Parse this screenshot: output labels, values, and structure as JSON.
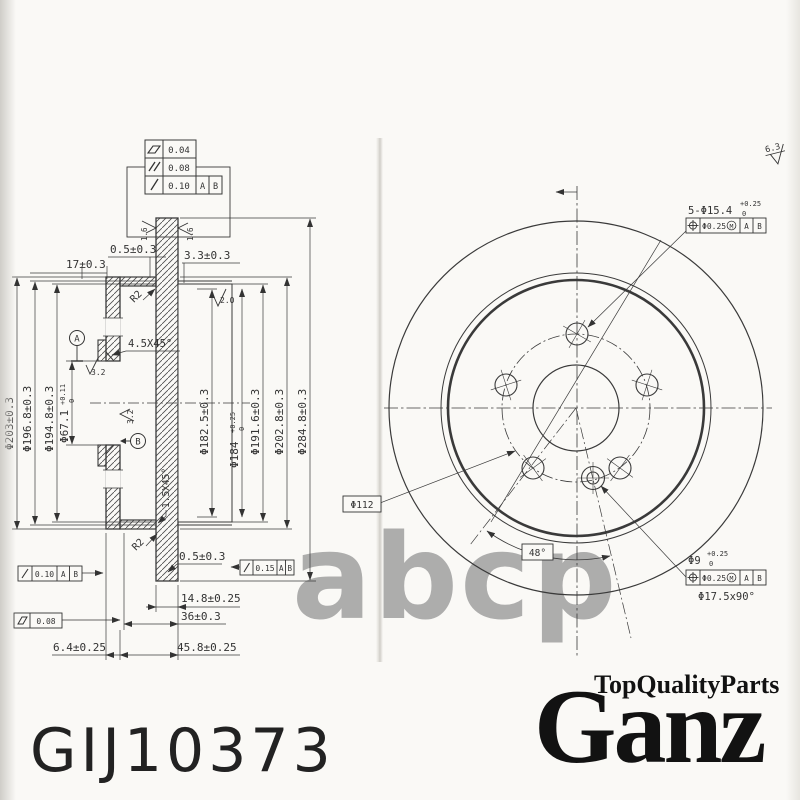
{
  "paper": {
    "bg": "#faf9f6",
    "line_color": "#3a3a3a",
    "watermark_color": "#a0a0a0"
  },
  "watermark": {
    "text": "abcp"
  },
  "part_number": "GIJ10373",
  "brand": {
    "tagline": "TopQualityParts",
    "name": "Ganz"
  },
  "tolerance_table": {
    "rows": [
      {
        "symbol_name": "flatness-symbol",
        "value": "0.04"
      },
      {
        "symbol_name": "parallelism-symbol",
        "value": "0.08"
      },
      {
        "symbol_name": "runout-symbol",
        "value": "0.10",
        "datum_1": "A",
        "datum_2": "B"
      }
    ]
  },
  "section_view": {
    "dims_top": {
      "d17": "17±0.3",
      "d05": "0.5±0.3",
      "d33": "3.3±0.3"
    },
    "roughness": {
      "r16_left": "1.6",
      "r16_right": "1.6",
      "r20": "2.0",
      "r32_hub": "3.2",
      "r32_face": "3.2"
    },
    "radii": {
      "r2_top": "R2",
      "r2_bottom": "R2"
    },
    "chamfers": {
      "c45": "4.5X45°",
      "c15": "1.5X45°"
    },
    "diameters_left": {
      "d203": "Φ203±0.3",
      "d196": "Φ196.8±0.3",
      "d194": "Φ194.8±0.3",
      "d67_main": "Φ67.1",
      "d67_tol_up": "+0.11",
      "d67_tol_dn": "0"
    },
    "diameters_right": {
      "d182": "Φ182.5±0.3",
      "d184_main": "Φ184",
      "d184_tol_up": "+0.25",
      "d184_tol_dn": "0",
      "d191": "Φ191.6±0.3",
      "d202": "Φ202.8±0.3",
      "d284": "Φ284.8±0.3"
    },
    "datums": {
      "a": "A",
      "b": "B"
    },
    "dims_bottom": {
      "d05": "0.5±0.3",
      "d148": "14.8±0.25",
      "d36": "36±0.3",
      "d64": "6.4±0.25",
      "d458": "45.8±0.25"
    },
    "fcf": {
      "runout_face": {
        "value": "0.15",
        "datum_1": "A",
        "datum_2": "B"
      },
      "runout_hub": {
        "value": "0.10",
        "datum_1": "A",
        "datum_2": "B"
      },
      "flatness": {
        "value": "0.08"
      }
    }
  },
  "front_view": {
    "roughness": "6.3",
    "bolt_holes": {
      "label": "5-Φ15.4",
      "tol_up": "+0.25",
      "tol_dn": "0",
      "fcf_value": "Φ0.25",
      "fcf_mod": "M",
      "fcf_datum_1": "A",
      "fcf_datum_2": "B"
    },
    "bolt_circle": "Φ112",
    "angle": "48°",
    "screw_hole": {
      "label": "Φ9",
      "tol_up": "+0.25",
      "tol_dn": "0",
      "fcf_value": "Φ0.25",
      "fcf_mod": "M",
      "fcf_datum_1": "A",
      "fcf_datum_2": "B",
      "countersink": "Φ17.5x90°"
    }
  }
}
